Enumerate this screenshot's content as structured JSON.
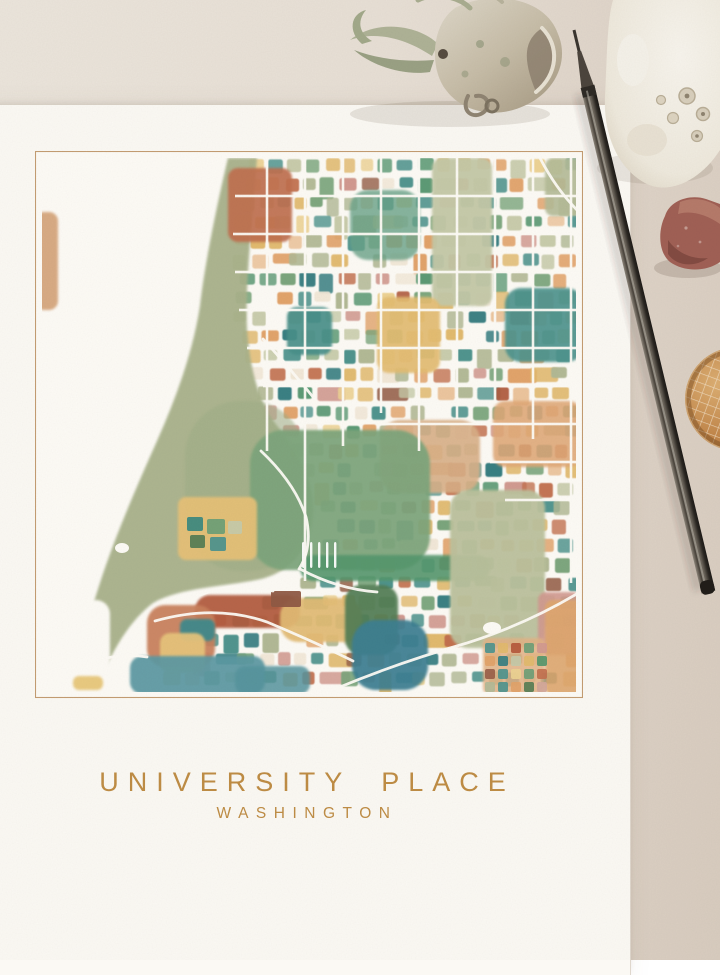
{
  "page": {
    "title_line1": "UNIVERSITY PLACE",
    "title_line2": "WASHINGTON"
  },
  "colors": {
    "table": "#e7dfd5",
    "print_paper": "#fbf9f4",
    "title_gold": "#bf8d45",
    "map_border": "#c49d72",
    "map_paper": "#fdfbf6"
  },
  "props": {
    "plant_label": "dried air plant",
    "coral_label": "white coral rock",
    "rock_label": "red lava rock",
    "ball_label": "woven sphere shell",
    "pen_label": "metal pen"
  },
  "map": {
    "border_color": "#c49d72",
    "palette": [
      {
        "c": "#b2b995",
        "w": 0.13
      },
      {
        "c": "#c7cba9",
        "w": 0.07
      },
      {
        "c": "#7aa57b",
        "w": 0.12
      },
      {
        "c": "#5b9a74",
        "w": 0.06
      },
      {
        "c": "#4f948e",
        "w": 0.11
      },
      {
        "c": "#377f82",
        "w": 0.04
      },
      {
        "c": "#e2ba6e",
        "w": 0.11
      },
      {
        "c": "#edd292",
        "w": 0.06
      },
      {
        "c": "#e2a36a",
        "w": 0.1
      },
      {
        "c": "#ecc49b",
        "w": 0.05
      },
      {
        "c": "#c3714f",
        "w": 0.06
      },
      {
        "c": "#b05a3e",
        "w": 0.03
      },
      {
        "c": "#d29a90",
        "w": 0.05
      },
      {
        "c": "#96604a",
        "w": 0.03
      },
      {
        "c": "#f2e8d8",
        "w": 0.03
      },
      {
        "c": null,
        "w": 0.04
      }
    ],
    "grid": {
      "seed": 11,
      "y0": 7,
      "y1": 537,
      "x1": 541,
      "step": 19,
      "cw": 14,
      "ch": 12,
      "gap": 3,
      "inner": [
        [
          7,
          212
        ],
        [
          60,
          203
        ],
        [
          120,
          199
        ],
        [
          180,
          203
        ],
        [
          240,
          222
        ],
        [
          300,
          262
        ],
        [
          340,
          282
        ],
        [
          400,
          292
        ],
        [
          430,
          262
        ],
        [
          470,
          160
        ],
        [
          537,
          118
        ]
      ]
    },
    "masses": [
      {
        "name": "shore-band",
        "type": "path",
        "d": "M193,7 C184,45 170,110 165,155 C158,200 142,245 122,290 C102,335 80,385 64,435 C52,472 44,505 41,539 L62,539 C74,505 92,472 118,452 C146,436 190,436 226,428 C258,420 276,395 278,362 C280,330 262,300 240,272 C222,248 215,215 212,178 C210,135 217,70 222,7 Z",
        "fill": "#a9b28b",
        "op": 0.95
      },
      {
        "name": "shore-band-soft",
        "type": "rect",
        "x": 150,
        "y": 250,
        "w": 120,
        "h": 170,
        "rx": 55,
        "fill": "#9fae87",
        "op": 0.55
      },
      {
        "name": "white-bay",
        "type": "rect",
        "x": 25,
        "y": 449,
        "w": 50,
        "h": 95,
        "rx": 14,
        "fill": "#fdfbf6",
        "op": 1
      },
      {
        "name": "peach-island",
        "type": "rect",
        "x": 0,
        "y": 61,
        "w": 23,
        "h": 98,
        "rx": 9,
        "fill": "#d7a77e",
        "op": 0.95
      },
      {
        "name": "pale-park",
        "type": "rect",
        "x": 397,
        "y": 7,
        "w": 60,
        "h": 148,
        "rx": 10,
        "fill": "#c5c9a8",
        "op": 0.95
      },
      {
        "name": "green-upper-mid",
        "type": "rect",
        "x": 315,
        "y": 39,
        "w": 70,
        "h": 70,
        "rx": 18,
        "fill": "#6aa389",
        "op": 0.8
      },
      {
        "name": "teal-top-right",
        "type": "rect",
        "x": 470,
        "y": 137,
        "w": 78,
        "h": 74,
        "rx": 16,
        "fill": "#4f948e",
        "op": 0.92
      },
      {
        "name": "teal-mid-left",
        "type": "rect",
        "x": 252,
        "y": 156,
        "w": 45,
        "h": 48,
        "rx": 10,
        "fill": "#48908a",
        "op": 0.92
      },
      {
        "name": "ochre-center",
        "type": "rect",
        "x": 342,
        "y": 146,
        "w": 63,
        "h": 76,
        "rx": 12,
        "fill": "#e4bd72",
        "op": 0.92
      },
      {
        "name": "buff-belt",
        "type": "rect",
        "x": 345,
        "y": 269,
        "w": 100,
        "h": 73,
        "rx": 20,
        "fill": "#d9b088",
        "op": 0.9
      },
      {
        "name": "peach-row-right",
        "type": "rect",
        "x": 458,
        "y": 250,
        "w": 88,
        "h": 66,
        "rx": 12,
        "fill": "#e0a877",
        "op": 0.88
      },
      {
        "name": "green-center-mass",
        "type": "rect",
        "x": 215,
        "y": 279,
        "w": 180,
        "h": 140,
        "rx": 34,
        "fill": "#7da57c",
        "op": 0.93
      },
      {
        "name": "ochre-lower-left",
        "type": "rect",
        "x": 143,
        "y": 346,
        "w": 79,
        "h": 63,
        "rx": 8,
        "fill": "#e6c178",
        "op": 0.95
      },
      {
        "name": "emerald-strip",
        "type": "rect",
        "x": 265,
        "y": 404,
        "w": 190,
        "h": 26,
        "rx": 13,
        "fill": "#55976d",
        "op": 0.9
      },
      {
        "name": "sage-bottom-right",
        "type": "rect",
        "x": 415,
        "y": 339,
        "w": 95,
        "h": 158,
        "rx": 18,
        "fill": "#bcc29e",
        "op": 0.95
      },
      {
        "name": "rust-ravine",
        "type": "rect",
        "x": 160,
        "y": 444,
        "w": 105,
        "h": 33,
        "rx": 15,
        "fill": "#b25a3e",
        "op": 0.93
      },
      {
        "name": "ochre-blob",
        "type": "rect",
        "x": 245,
        "y": 447,
        "w": 82,
        "h": 44,
        "rx": 18,
        "fill": "#e3bc74",
        "op": 0.93
      },
      {
        "name": "dark-green",
        "type": "rect",
        "x": 310,
        "y": 434,
        "w": 53,
        "h": 70,
        "rx": 16,
        "fill": "#527e55",
        "op": 0.93
      },
      {
        "name": "deep-blue",
        "type": "rect",
        "x": 317,
        "y": 469,
        "w": 76,
        "h": 70,
        "rx": 24,
        "fill": "#3d7f92",
        "op": 0.93
      },
      {
        "name": "salmon-bl",
        "type": "rect",
        "x": 112,
        "y": 454,
        "w": 68,
        "h": 62,
        "rx": 18,
        "fill": "#c9805c",
        "op": 0.93
      },
      {
        "name": "teal-bl-inner",
        "type": "rect",
        "x": 145,
        "y": 468,
        "w": 35,
        "h": 22,
        "rx": 7,
        "fill": "#3f8a8c",
        "op": 0.95
      },
      {
        "name": "yellow-bl-inner",
        "type": "rect",
        "x": 125,
        "y": 482,
        "w": 45,
        "h": 40,
        "rx": 10,
        "fill": "#e7c47c",
        "op": 0.95
      },
      {
        "name": "teal-bottom-left",
        "type": "rect",
        "x": 95,
        "y": 505,
        "w": 135,
        "h": 38,
        "rx": 12,
        "fill": "#5b99a3",
        "op": 0.93
      },
      {
        "name": "teal-bottom-ext",
        "type": "rect",
        "x": 200,
        "y": 515,
        "w": 75,
        "h": 28,
        "rx": 10,
        "fill": "#57949e",
        "op": 0.85
      },
      {
        "name": "yellow-beach",
        "type": "rect",
        "x": 38,
        "y": 525,
        "w": 30,
        "h": 14,
        "rx": 6,
        "fill": "#e8c87a",
        "op": 0.95
      },
      {
        "name": "rose-cluster-right",
        "type": "rect",
        "x": 503,
        "y": 441,
        "w": 42,
        "h": 63,
        "rx": 8,
        "fill": "#d29a90",
        "op": 0.9
      },
      {
        "name": "peach-bottom-right",
        "type": "rect",
        "x": 510,
        "y": 449,
        "w": 38,
        "h": 95,
        "rx": 8,
        "fill": "#dfa76e",
        "op": 0.9
      },
      {
        "name": "peach-tile-bg",
        "type": "rect",
        "x": 448,
        "y": 487,
        "w": 62,
        "h": 56,
        "rx": 6,
        "fill": "#e3b285",
        "op": 0.85
      },
      {
        "name": "rust-cluster-top-left",
        "type": "rect",
        "x": 193,
        "y": 17,
        "w": 64,
        "h": 74,
        "rx": 10,
        "fill": "#c06f50",
        "op": 0.92
      },
      {
        "name": "sage-hwy-corner",
        "type": "rect",
        "x": 510,
        "y": 7,
        "w": 38,
        "h": 58,
        "rx": 8,
        "fill": "#b4bb97",
        "op": 0.9
      }
    ],
    "details": [
      [
        152,
        366,
        16,
        14,
        "#3f8a80"
      ],
      [
        172,
        368,
        18,
        15,
        "#6fa077"
      ],
      [
        193,
        370,
        14,
        13,
        "#c6caaa"
      ],
      [
        155,
        384,
        15,
        13,
        "#577e55"
      ],
      [
        175,
        386,
        16,
        14,
        "#4f948e"
      ],
      [
        267,
        391,
        2.4,
        26,
        "#ffffff"
      ],
      [
        275,
        391,
        2.4,
        26,
        "#ffffff"
      ],
      [
        283,
        391,
        2.4,
        26,
        "#ffffff"
      ],
      [
        291,
        391,
        2.4,
        26,
        "#ffffff"
      ],
      [
        299,
        391,
        2.4,
        26,
        "#ffffff"
      ],
      [
        236,
        440,
        30,
        16,
        "#8f5a45"
      ]
    ],
    "tiles": {
      "x": 450,
      "y": 492,
      "cols": 5,
      "rows": 4,
      "size": 10,
      "gap": 3,
      "colors": [
        "#4f948e",
        "#e2ba6e",
        "#b5593c",
        "#6fa077",
        "#d29a90",
        "#e2a36a",
        "#377f82",
        "#c6caaa",
        "#e2ba6e",
        "#55976d",
        "#9a5f49",
        "#4f948e",
        "#edd292",
        "#6fa077",
        "#c3714f",
        "#b3ba97",
        "#4f948e",
        "#e2a36a",
        "#577e55",
        "#d2a79a"
      ]
    },
    "roads": {
      "verticals": [
        [
          232,
          7,
          300
        ],
        [
          270,
          7,
          430
        ],
        [
          308,
          7,
          295
        ],
        [
          346,
          7,
          262
        ],
        [
          384,
          7,
          300
        ],
        [
          422,
          7,
          268
        ],
        [
          460,
          7,
          252
        ],
        [
          498,
          7,
          288
        ],
        [
          536,
          7,
          432
        ]
      ],
      "horizontals": [
        [
          45,
          200,
          541
        ],
        [
          83,
          198,
          541
        ],
        [
          121,
          200,
          541
        ],
        [
          159,
          204,
          541
        ],
        [
          197,
          212,
          541
        ],
        [
          235,
          228,
          541
        ],
        [
          273,
          345,
          541
        ],
        [
          311,
          455,
          541
        ],
        [
          349,
          470,
          541
        ]
      ],
      "paths": [
        "M228,188 Q252,214 278,246",
        "M226,300 Q260,332 271,366 Q278,396 264,418",
        "M120,470 Q180,453 232,471 Q282,492 318,510",
        "M265,418 Q302,438 342,441",
        "M300,538 Q362,512 432,492 Q492,473 545,441",
        "M505,7 Q521,38 543,60",
        "M41,518 Q78,500 112,506",
        "M165,444 Q200,430 238,440"
      ]
    },
    "ponds": [
      [
        87,
        397,
        7,
        5
      ],
      [
        457,
        477,
        9,
        6
      ]
    ]
  }
}
